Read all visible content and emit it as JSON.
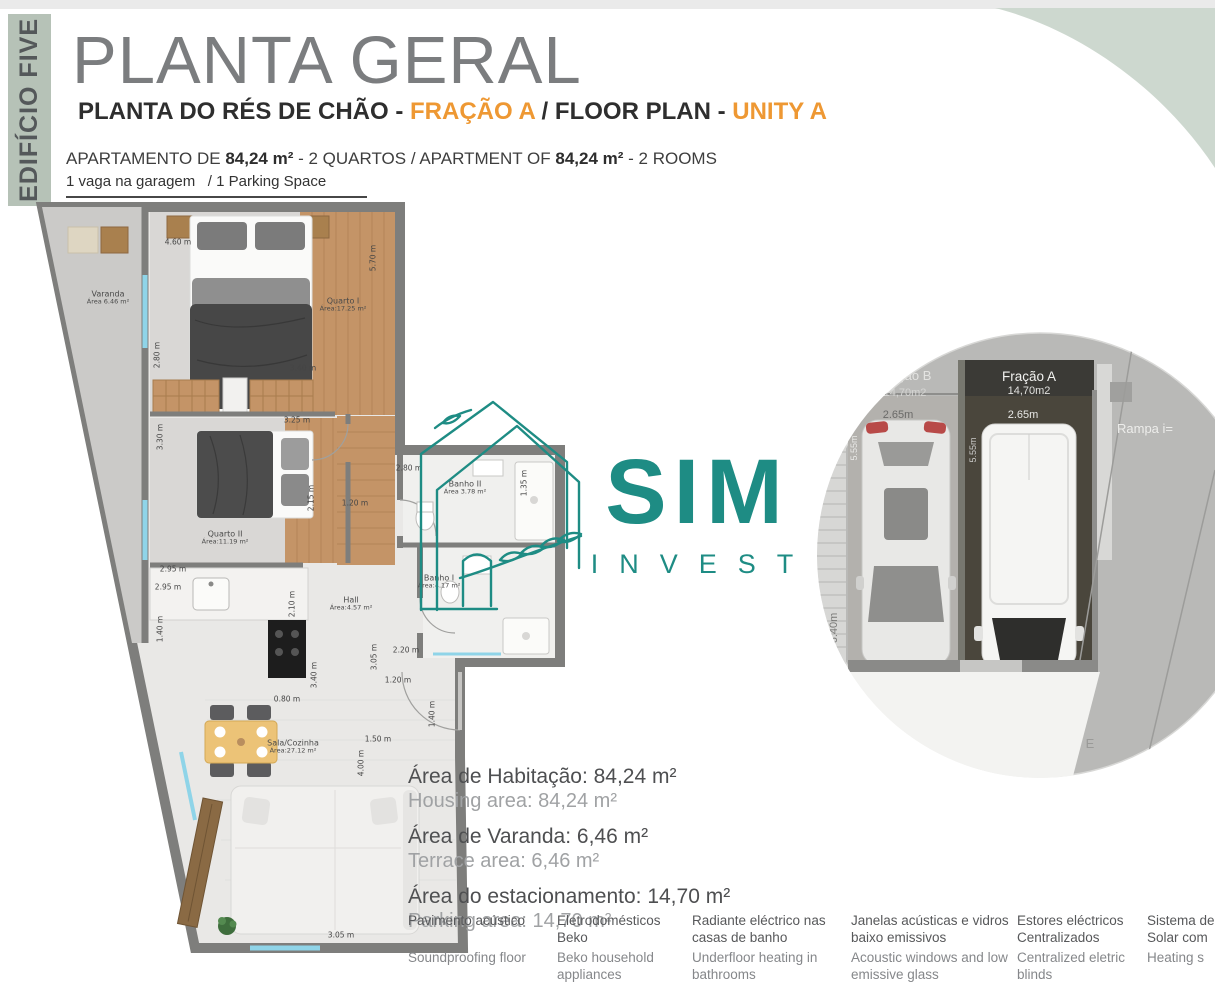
{
  "header": {
    "building_tab": "EDIFÍCIO FIVE",
    "title": "PLANTA GERAL",
    "subtitle": {
      "pt_label": "PLANTA DO RÉS DE CHÃO - ",
      "pt_accent": "FRAÇÃO A",
      "separator": " / ",
      "en_label": "FLOOR PLAN - ",
      "en_accent": "UNITY A"
    },
    "apartment_line": {
      "prefix": "APARTAMENTO DE ",
      "area_pt": "84,24 m²",
      "middle": " - 2 QUARTOS / APARTMENT OF ",
      "area_en": "84,24 m²",
      "suffix": " - 2 ROOMS"
    },
    "parking_line": "1 vaga na garagem   / 1 Parking Space"
  },
  "floor_plan": {
    "room_labels": [
      {
        "name": "Varanda",
        "area": "Área 6.46 m²",
        "x": 73,
        "y": 98
      },
      {
        "name": "Quarto I",
        "area": "Área:17.25 m²",
        "x": 308,
        "y": 105
      },
      {
        "name": "Quarto II",
        "area": "Área:11.19 m²",
        "x": 190,
        "y": 338
      },
      {
        "name": "Banho II",
        "area": "Área 3.78 m²",
        "x": 430,
        "y": 288
      },
      {
        "name": "Banho I",
        "area": "Área:4.17 m²",
        "x": 404,
        "y": 382
      },
      {
        "name": "Hall",
        "area": "Área:4.57 m²",
        "x": 316,
        "y": 404
      },
      {
        "name": "Sala/Cozinha",
        "area": "Área:27.12 m²",
        "x": 258,
        "y": 547
      }
    ],
    "dimensions": [
      {
        "label": "4.60 m",
        "x": 143,
        "y": 42,
        "r": 0
      },
      {
        "label": "5.70 m",
        "x": 338,
        "y": 58,
        "r": 1
      },
      {
        "label": "2.80 m",
        "x": 122,
        "y": 155,
        "r": 1
      },
      {
        "label": "3.40 m",
        "x": 268,
        "y": 168,
        "r": 0
      },
      {
        "label": "3.25 m",
        "x": 262,
        "y": 220,
        "r": 0
      },
      {
        "label": "3.30 m",
        "x": 125,
        "y": 237,
        "r": 1
      },
      {
        "label": "2.15 m",
        "x": 276,
        "y": 298,
        "r": 1
      },
      {
        "label": "1.20 m",
        "x": 320,
        "y": 303,
        "r": 0
      },
      {
        "label": "2.80 m",
        "x": 374,
        "y": 268,
        "r": 0
      },
      {
        "label": "1.35 m",
        "x": 489,
        "y": 283,
        "r": 1
      },
      {
        "label": "2.95 m",
        "x": 138,
        "y": 369,
        "r": 0
      },
      {
        "label": "2.95 m",
        "x": 133,
        "y": 387,
        "r": 0
      },
      {
        "label": "1.40 m",
        "x": 125,
        "y": 429,
        "r": 1
      },
      {
        "label": "2.10 m",
        "x": 257,
        "y": 404,
        "r": 1
      },
      {
        "label": "2.20 m",
        "x": 371,
        "y": 450,
        "r": 0
      },
      {
        "label": "3.05 m",
        "x": 339,
        "y": 457,
        "r": 1
      },
      {
        "label": "1.20 m",
        "x": 363,
        "y": 480,
        "r": 0
      },
      {
        "label": "3.40 m",
        "x": 279,
        "y": 475,
        "r": 1
      },
      {
        "label": "0.80 m",
        "x": 252,
        "y": 499,
        "r": 0
      },
      {
        "label": "1.40 m",
        "x": 397,
        "y": 514,
        "r": 1
      },
      {
        "label": "1.50 m",
        "x": 343,
        "y": 539,
        "r": 0
      },
      {
        "label": "4.00 m",
        "x": 326,
        "y": 563,
        "r": 1
      },
      {
        "label": "3.05 m",
        "x": 306,
        "y": 735,
        "r": 0
      }
    ]
  },
  "logo": {
    "word": "SIM",
    "sub": "INVEST"
  },
  "parking_inset": {
    "stall_b_label": "Fração B",
    "stall_b_area": "14,70m2",
    "stall_a_label": "Fração A",
    "stall_a_area": "14,70m2",
    "width_b": "2.65m",
    "width_a": "2.65m",
    "depth_b": "5.55m",
    "depth_a": "5.55m",
    "side_dim": "6.40m",
    "ramp_label": "Rampa i=",
    "corner_label": "E"
  },
  "areas": [
    {
      "pt": "Área de Habitação: 84,24 m²",
      "en": "Housing area: 84,24 m²"
    },
    {
      "pt": "Área de Varanda: 6,46 m²",
      "en": "Terrace area: 6,46 m²"
    },
    {
      "pt": "Área do estacionamento: 14,70 m²",
      "en": "Parking area: 14,70 m²"
    }
  ],
  "features": [
    {
      "pt": "Pavimento acústico",
      "en": "Soundproofing floor"
    },
    {
      "pt": "Eletrodomésticos Beko",
      "en": "Beko household appliances"
    },
    {
      "pt": "Radiante eléctrico nas casas de banho",
      "en": "Underfloor heating in bathrooms"
    },
    {
      "pt": "Janelas acústicas e vidros baixo emissivos",
      "en": "Acoustic windows and low emissive glass"
    },
    {
      "pt": "Estores eléctricos Centralizados",
      "en": "Centralized eletric blinds"
    },
    {
      "pt": "Sistema de Solar com",
      "en": "Heating s"
    }
  ],
  "colors": {
    "accent_orange": "#ee9833",
    "brand_teal": "#1e8c84",
    "sage": "#cdd8cf",
    "tab_sage": "#b6c2b7"
  }
}
